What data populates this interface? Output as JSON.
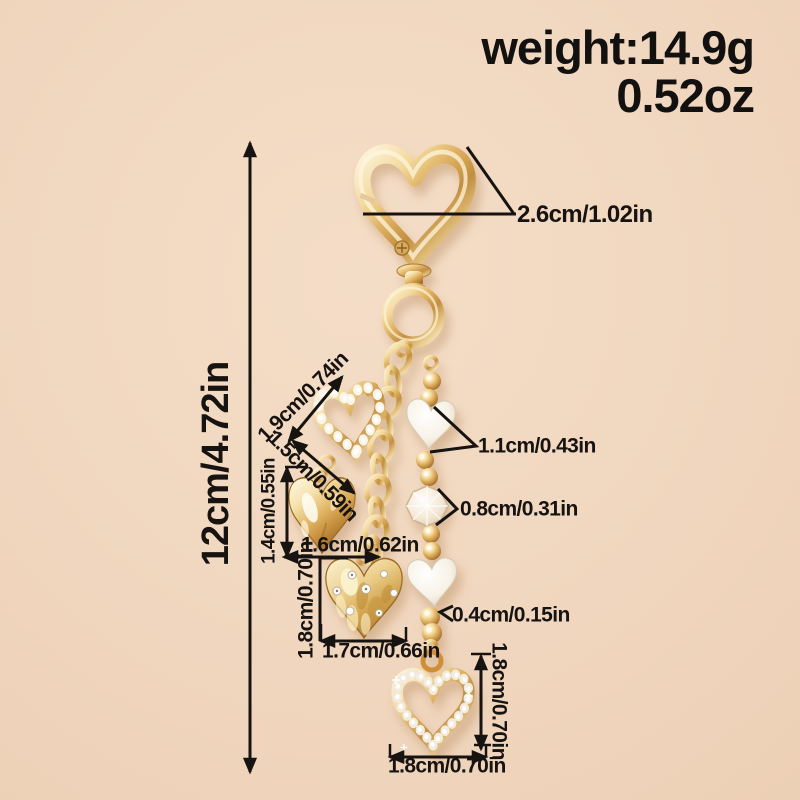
{
  "product": {
    "weight_line1": "weight:14.9g",
    "weight_line2": "0.52oz"
  },
  "dimensions": {
    "clasp_width": "2.6cm/1.02in",
    "total_length": "12cm/4.72in",
    "pearl_heart_width": "1.9cm/0.74in",
    "pearl_heart_height": "1.5cm/0.59in",
    "glossy_heart_height": "1.4cm/0.55in",
    "glossy_heart_width": "1.6cm/0.62in",
    "white_heart_bead_size": "1.1cm/0.43in",
    "crystal_bead_size": "0.8cm/0.31in",
    "hammered_heart_height": "1.8cm/0.70in",
    "hammered_heart_width": "1.7cm/0.66in",
    "small_gold_bead_size": "0.4cm/0.15in",
    "rhinestone_heart_height": "1.8cm/0.70in",
    "rhinestone_heart_width": "1.8cm/0.70in"
  },
  "colors": {
    "background": "#EFD4BB",
    "gold": "#D9A85F",
    "pearl": "#F7F1E6",
    "annotation_text": "#161310"
  }
}
